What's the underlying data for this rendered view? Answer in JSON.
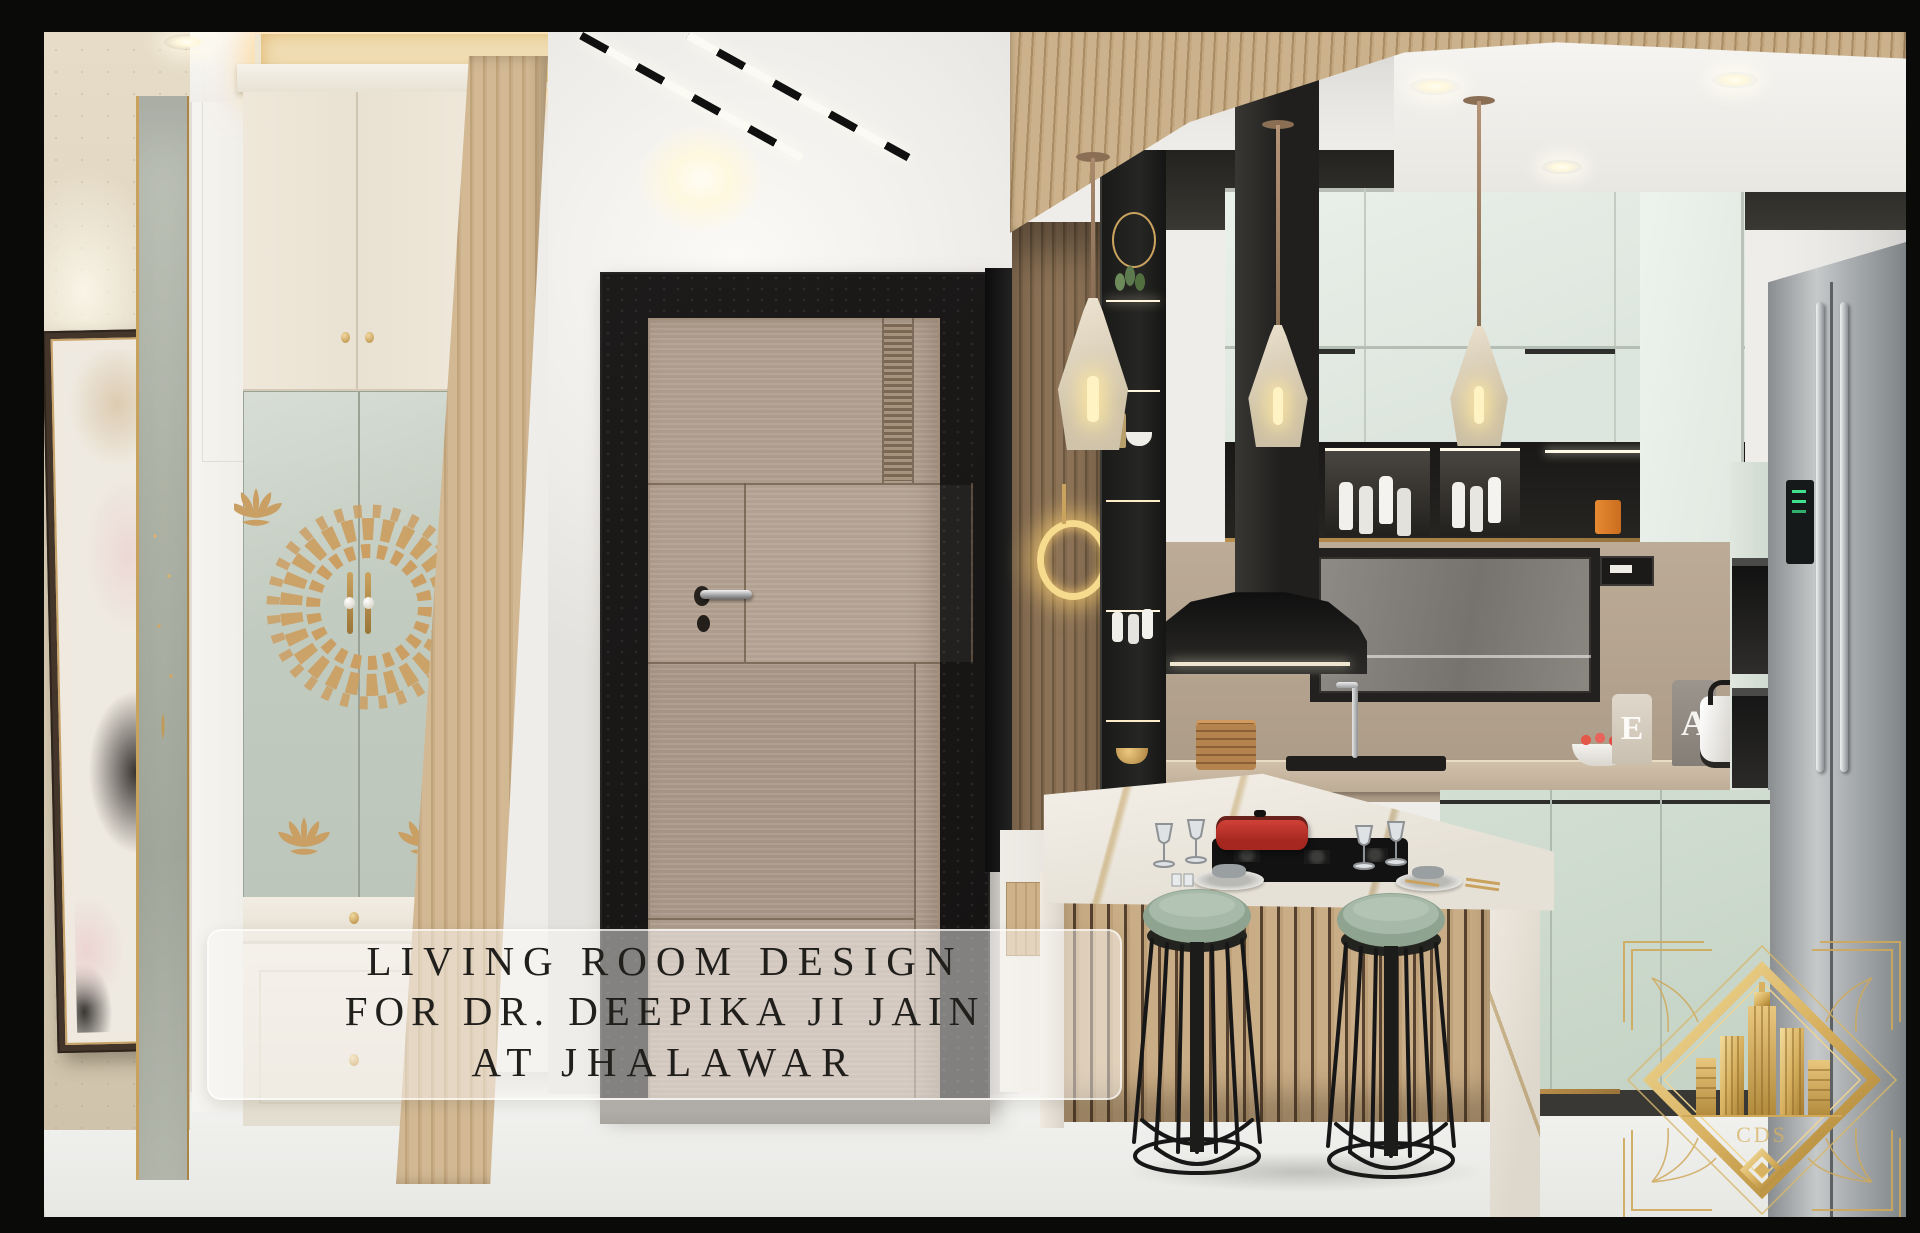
{
  "overlay": {
    "line1": "LIVING ROOM DESIGN",
    "line2": "FOR DR. DEEPIKA JI JAIN",
    "line3": "AT JHALAWAR",
    "text_color": "#211f1c"
  },
  "decor": {
    "board_left": "E",
    "board_right": "A"
  },
  "logo": {
    "monogram": "CDS",
    "gold": "#d8b261"
  },
  "palette": {
    "frame_black": "#0a0a09",
    "gold_accent": "#c9a063",
    "mint_cabinet": "#e2e9e2",
    "sage_glass": "#c2cbc0",
    "door_wood": "#b3a191",
    "slat_wood": "#c9ae89",
    "stool_seat": "#a7b9a8",
    "cookware_red": "#c2342f",
    "marble_floor": "#f1f1ef"
  }
}
